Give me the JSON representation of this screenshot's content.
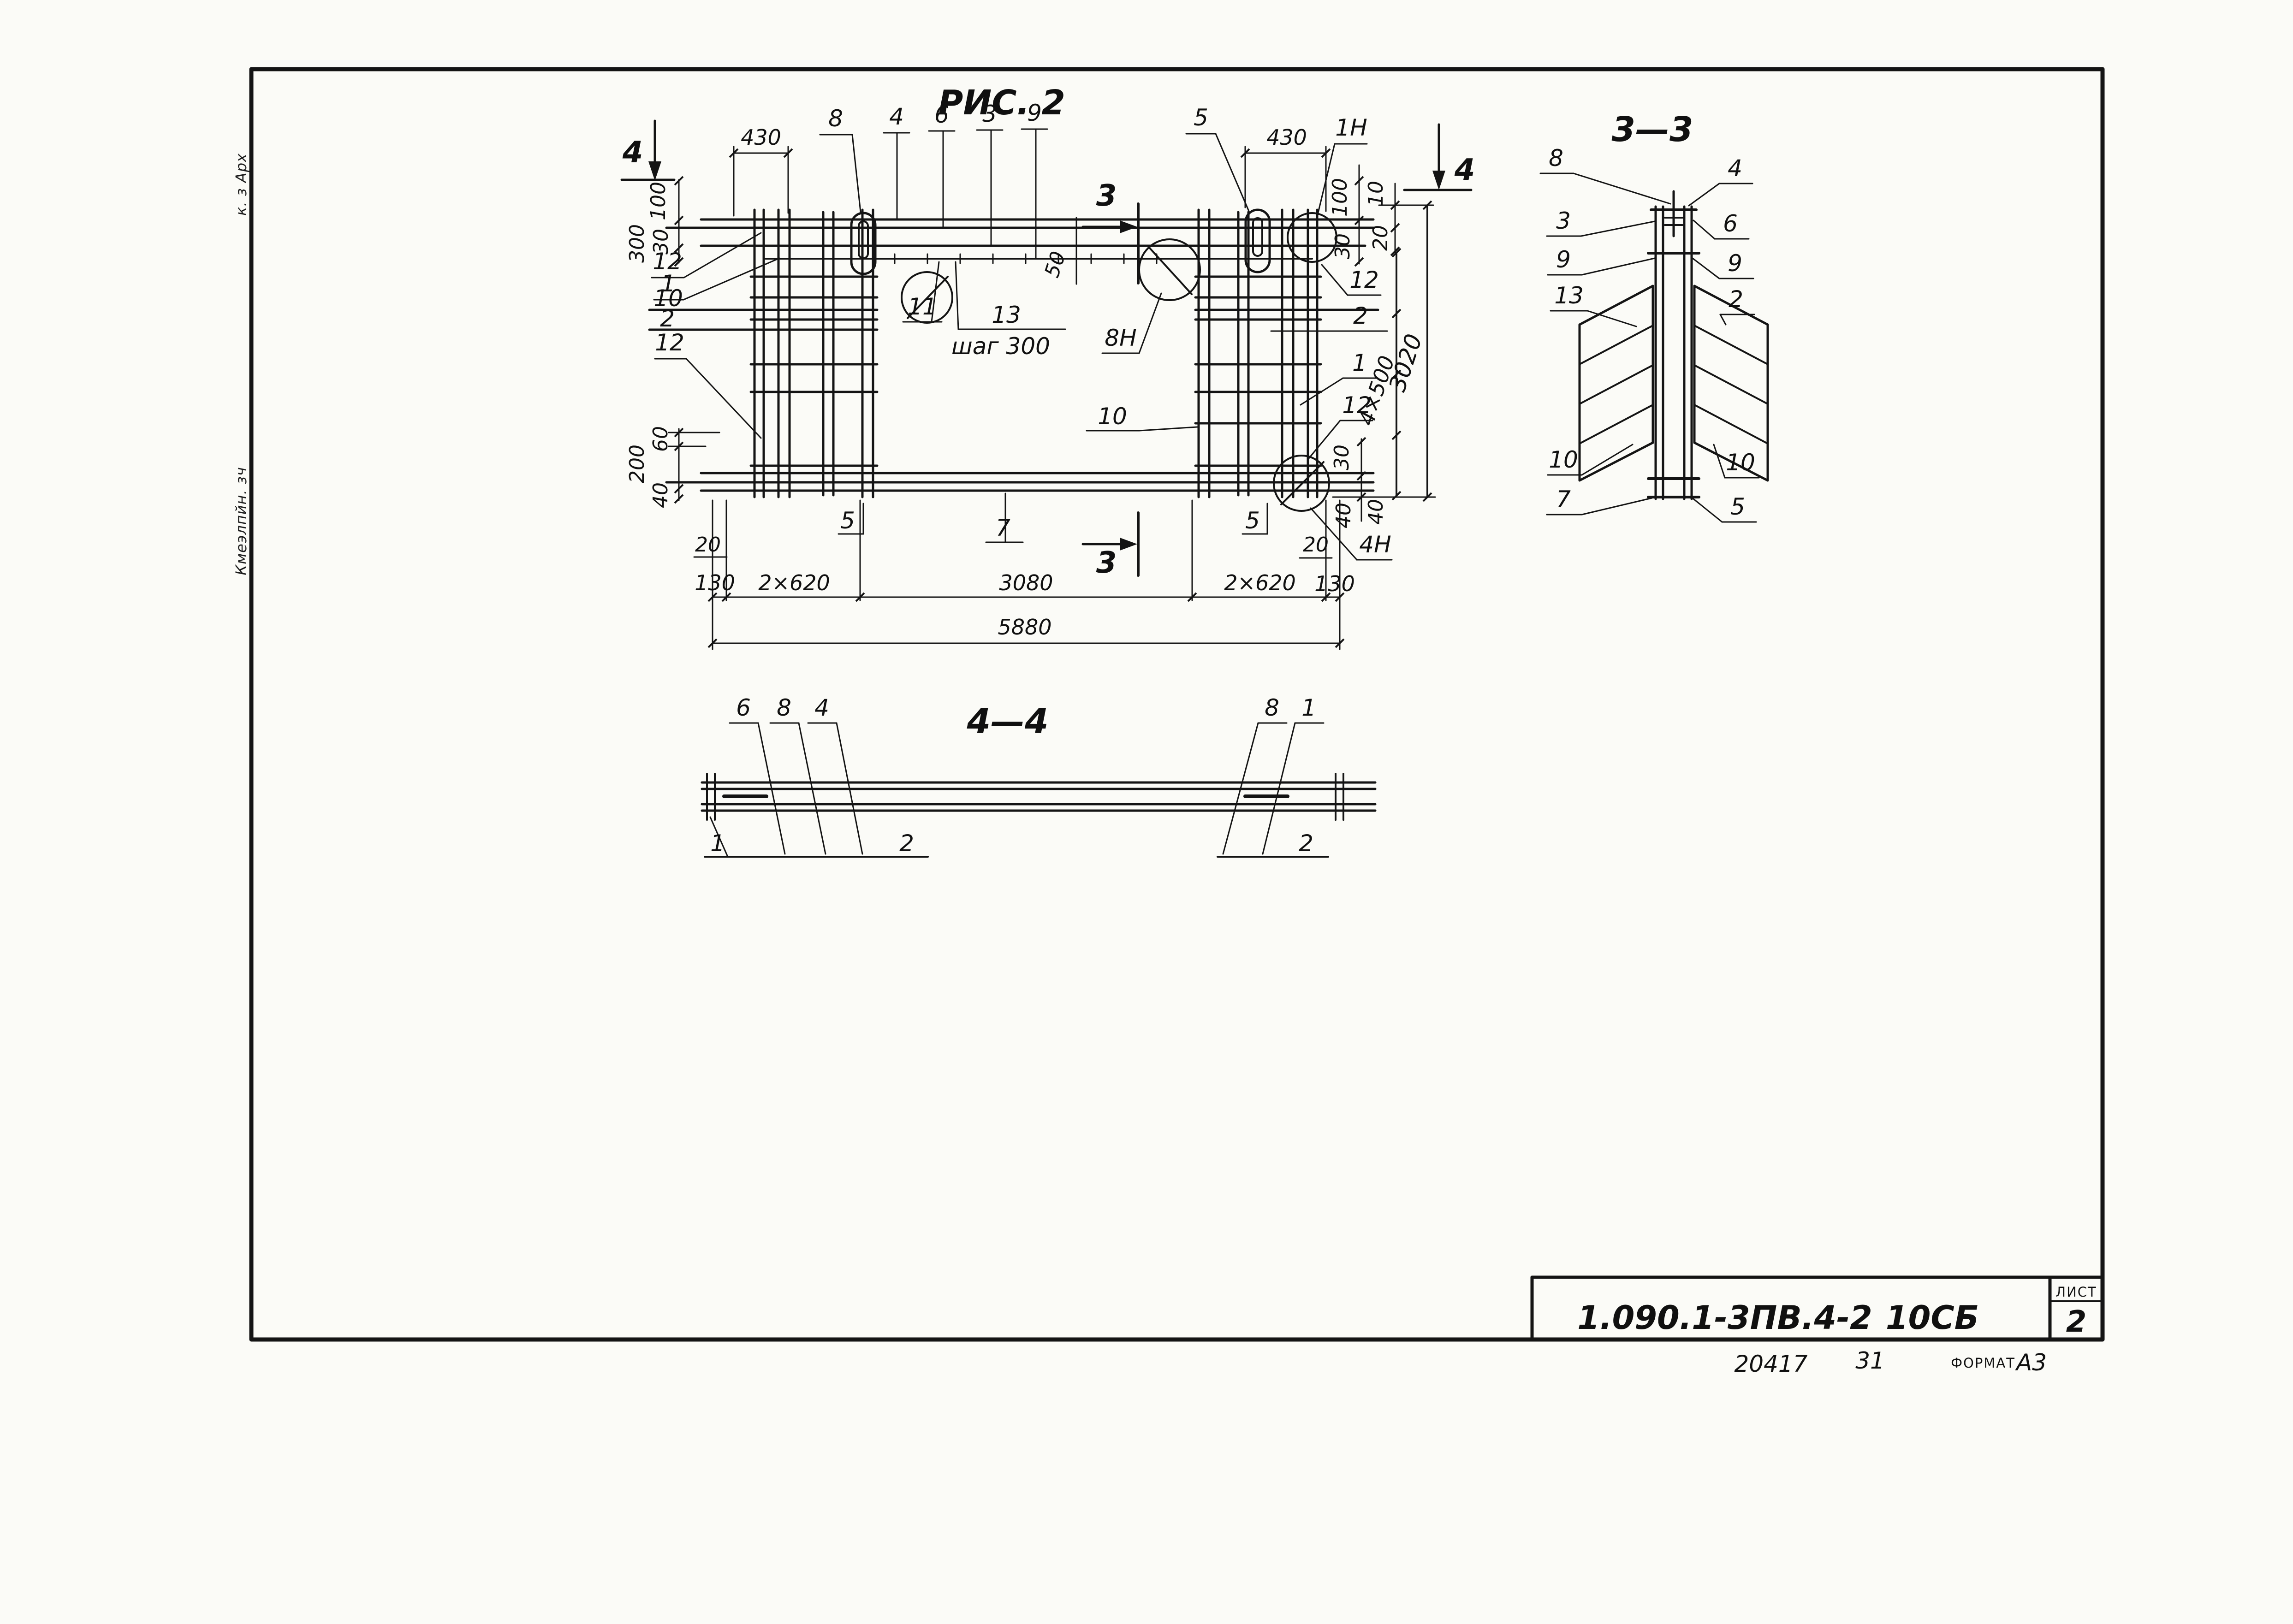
{
  "sheet": {
    "titles": {
      "figure": "РИС. 2",
      "section_3_3": "3—3",
      "section_4_4": "4—4"
    },
    "title_block": {
      "document_code": "1.090.1-3ПВ.4-2",
      "assembly_code": "10СБ",
      "sheet_label": "ЛИСТ",
      "sheet_number": "2",
      "note_number": "20417",
      "note_extra": "31",
      "format_label": "ФОРМАТ",
      "format_value": "А3"
    },
    "margin_stamps": {
      "upper": "к. з Арх",
      "lower": "Кмеэлпйн. зч"
    }
  },
  "callouts": {
    "p1": "1",
    "p2": "2",
    "p3": "3",
    "p4": "4",
    "p5": "5",
    "p6": "6",
    "p7": "7",
    "p8": "8",
    "p9": "9",
    "p10": "10",
    "p11": "11",
    "p12": "12",
    "p13": "13",
    "p1n": "1Н",
    "p4n": "4Н",
    "p8n": "8Н",
    "step_note": "шаг 300"
  },
  "dimensions": {
    "d10": "10",
    "d20": "20",
    "d30": "30",
    "d40": "40",
    "d50": "50",
    "d60": "60",
    "d100": "100",
    "d130": "130",
    "d200": "200",
    "d300": "300",
    "d430": "430",
    "d2x620": "2×620",
    "d3020": "3020",
    "d3080": "3080",
    "d4x500": "4×500",
    "d5880": "5880"
  }
}
